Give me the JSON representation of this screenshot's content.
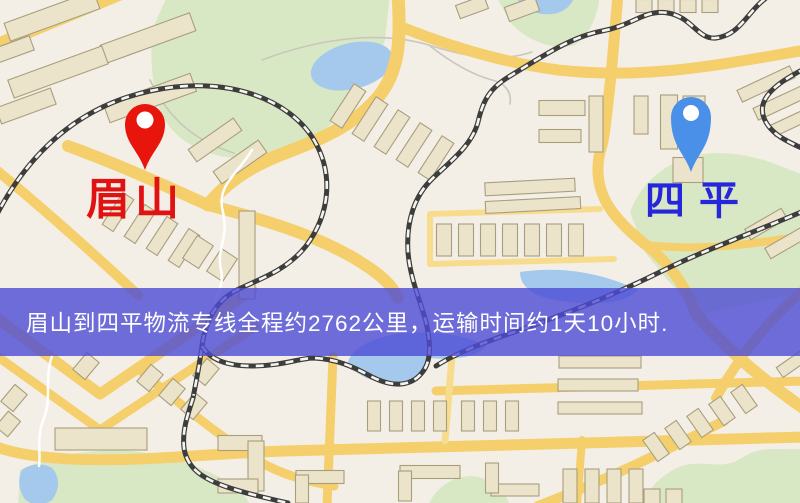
{
  "map": {
    "origin_marker": {
      "label": "眉山",
      "label_color": "#e01212",
      "pin_color": "#e8150c"
    },
    "destination_marker": {
      "label": "四平",
      "label_color": "#2626dc",
      "pin_color": "#4a8fe8"
    },
    "banner": {
      "text": "眉山到四平物流专线全程约2762公里，运输时间约1天10小时.",
      "distance_text": "约2762公里",
      "duration_text": "约1天10小时",
      "bg_color": "rgba(76,75,212,0.8)",
      "text_color": "#ffffff"
    },
    "palette": {
      "background": "#f4efe6",
      "park": "#d9e8c4",
      "water": "#a4c9ec",
      "road": "#f5cf6c",
      "road_minor": "#f8dc8e",
      "building": "#ebe3ca",
      "building_stroke": "#a89e7e",
      "railway": "#3d3d3d",
      "railway_dash": "#f6f4ee",
      "stream": "#ffffff",
      "trail": "#c9c6bd"
    }
  }
}
